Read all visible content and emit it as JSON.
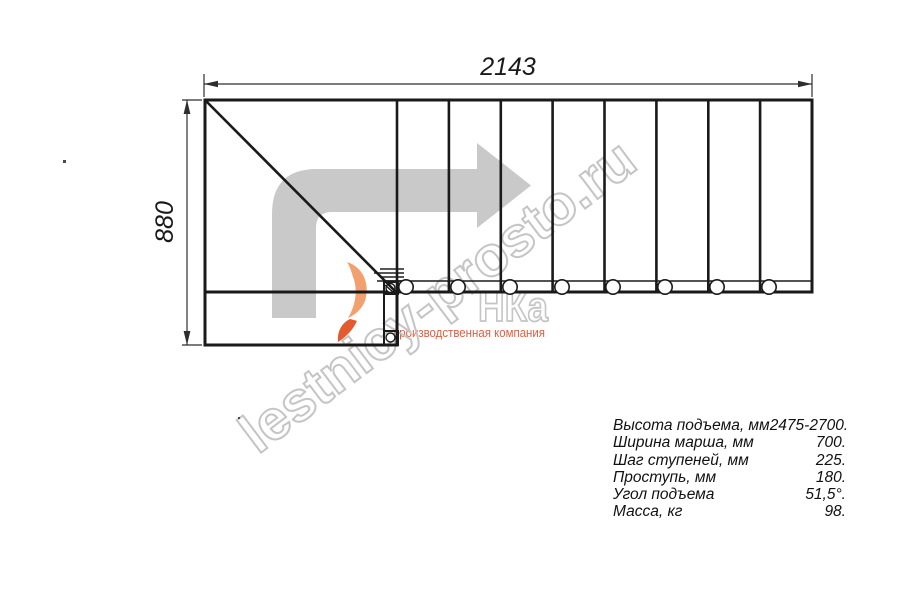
{
  "drawing": {
    "width_dim": "2143",
    "height_dim": "880"
  },
  "watermark": {
    "site_text": "lestnicy-prosto.ru",
    "logo_text": "НКа",
    "tagline": "производственная компания"
  },
  "specs": {
    "rows": [
      {
        "label": "Высота подъема, мм",
        "value": "2475-2700."
      },
      {
        "label": "Ширина марша, мм",
        "value": "700."
      },
      {
        "label": "Шаг ступеней, мм",
        "value": "225."
      },
      {
        "label": "Проступь, мм",
        "value": "180."
      },
      {
        "label": "Угол подъема",
        "value": "51,5°."
      },
      {
        "label": "Масса, кг",
        "value": "98."
      }
    ]
  },
  "colors": {
    "line": "#1a1a1a",
    "dimension": "#2e2e2e",
    "arrow_gray": "#c9c9c9",
    "watermark_gray": "#c5c5c5",
    "logo_orange_light": "#f2a06e",
    "logo_orange_dark": "#e25a2e",
    "tagline_orange": "#dd5f42"
  }
}
